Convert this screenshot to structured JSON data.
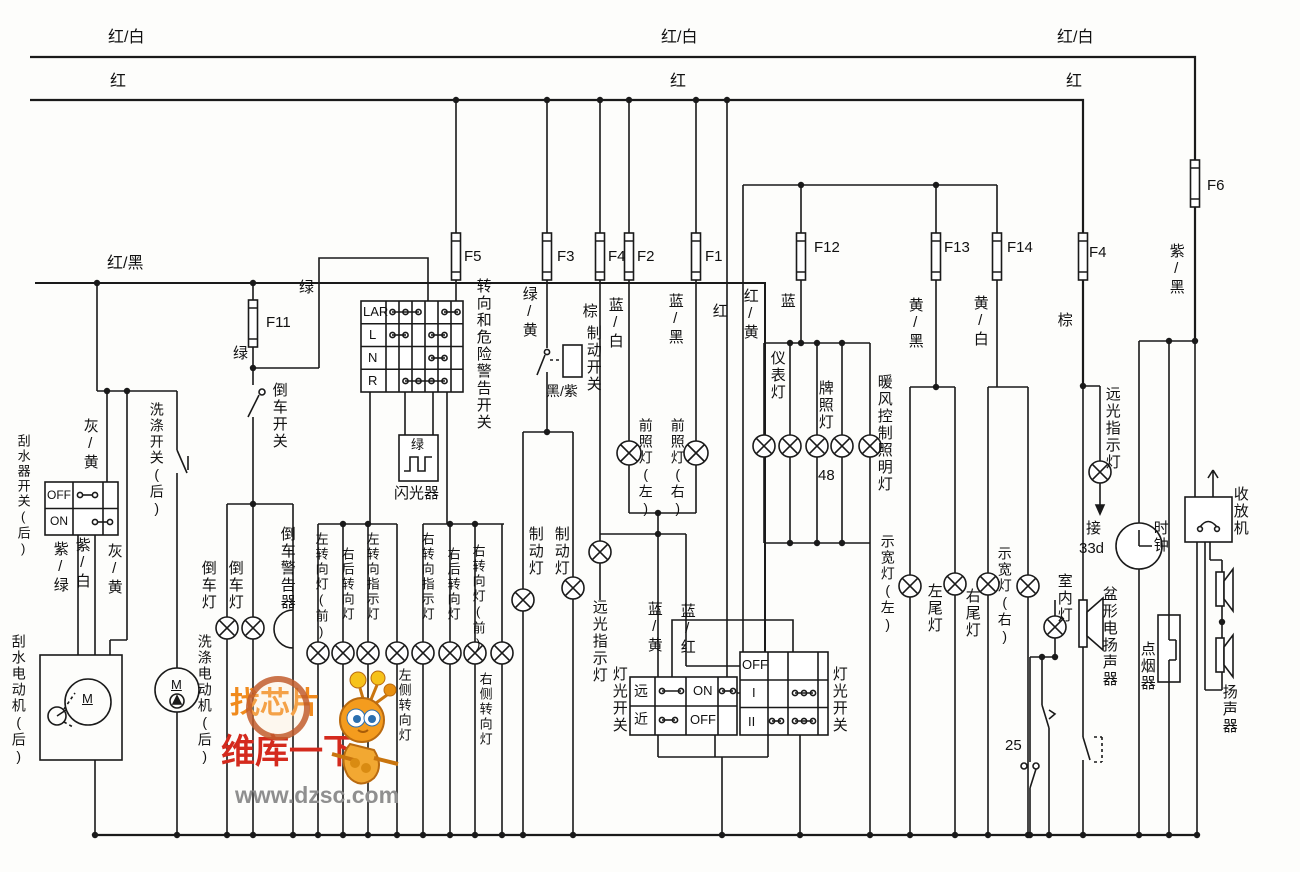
{
  "diagram_title": "汽车灯光与雨刮电路图",
  "watermark": {
    "line1": "找芯片",
    "line2": "维库一下",
    "line3": "www.dzsc.com",
    "color_orange": "#f08a1d",
    "color_red": "#d42a1d",
    "color_gray": "#8f8f8f"
  },
  "fuses": [
    "F1",
    "F2",
    "F3",
    "F4",
    "F5",
    "F6",
    "F11",
    "F12",
    "F13",
    "F14"
  ],
  "labels": [
    {
      "n": "bus-red-white-label-1",
      "t": "红/白",
      "x": 108,
      "y": 30,
      "o": "h",
      "fs": 16
    },
    {
      "n": "bus-red-white-label-2",
      "t": "红/白",
      "x": 661,
      "y": 30,
      "o": "h",
      "fs": 16
    },
    {
      "n": "bus-red-white-label-3",
      "t": "红/白",
      "x": 1057,
      "y": 30,
      "o": "h",
      "fs": 16
    },
    {
      "n": "bus-red-label-1",
      "t": "红",
      "x": 110,
      "y": 74,
      "o": "h",
      "fs": 16
    },
    {
      "n": "bus-red-label-2",
      "t": "红",
      "x": 670,
      "y": 74,
      "o": "h",
      "fs": 16
    },
    {
      "n": "bus-red-label-3",
      "t": "红",
      "x": 1066,
      "y": 74,
      "o": "h",
      "fs": 16
    },
    {
      "n": "bus-red-black-label",
      "t": "红/黑",
      "x": 107,
      "y": 256,
      "o": "h",
      "fs": 16
    },
    {
      "n": "fuse-label-f11",
      "t": "F11",
      "x": 266,
      "y": 315,
      "o": "h"
    },
    {
      "n": "wire-label-green-1",
      "t": "绿",
      "x": 299,
      "y": 280,
      "o": "h"
    },
    {
      "n": "wire-label-green-2",
      "t": "绿",
      "x": 233,
      "y": 346,
      "o": "h"
    },
    {
      "n": "reverse-switch-label",
      "t": "倒车开关",
      "x": 271,
      "y": 382,
      "o": "v"
    },
    {
      "n": "fuse-label-f5",
      "t": "F5",
      "x": 464,
      "y": 249,
      "o": "h"
    },
    {
      "n": "turn-hazard-switch-label",
      "t": "转向和危险警告开关",
      "x": 475,
      "y": 278,
      "o": "v"
    },
    {
      "n": "flasher-green-label",
      "t": "绿",
      "x": 411,
      "y": 438,
      "o": "h",
      "fs": 13
    },
    {
      "n": "flasher-label",
      "t": "闪光器",
      "x": 394,
      "y": 486,
      "o": "h"
    },
    {
      "n": "wire-label-green-yellow",
      "t": "绿/黄",
      "x": 521,
      "y": 286,
      "o": "v"
    },
    {
      "n": "wire-label-brown-1",
      "t": "棕",
      "x": 581,
      "y": 303,
      "o": "v"
    },
    {
      "n": "brake-switch-label",
      "t": "制动开关",
      "x": 585,
      "y": 325,
      "o": "v"
    },
    {
      "n": "wire-label-black-purple",
      "t": "黑/紫",
      "x": 546,
      "y": 384,
      "o": "h",
      "fs": 14
    },
    {
      "n": "wire-label-blue-white",
      "t": "蓝/白",
      "x": 607,
      "y": 297,
      "o": "v"
    },
    {
      "n": "fuse-label-f3",
      "t": "F3",
      "x": 557,
      "y": 249,
      "o": "h"
    },
    {
      "n": "fuse-label-f4",
      "t": "F4",
      "x": 608,
      "y": 249,
      "o": "h"
    },
    {
      "n": "fuse-label-f2",
      "t": "F2",
      "x": 637,
      "y": 249,
      "o": "h"
    },
    {
      "n": "fuse-label-f1",
      "t": "F1",
      "x": 705,
      "y": 249,
      "o": "h"
    },
    {
      "n": "wire-label-blue-black",
      "t": "蓝/黑",
      "x": 667,
      "y": 293,
      "o": "v"
    },
    {
      "n": "wire-label-red-v",
      "t": "红",
      "x": 711,
      "y": 303,
      "o": "v"
    },
    {
      "n": "headlamp-left-label",
      "t": "前照灯(左)",
      "x": 638,
      "y": 418,
      "o": "v",
      "fs": 14
    },
    {
      "n": "headlamp-right-label",
      "t": "前照灯(右)",
      "x": 670,
      "y": 418,
      "o": "v",
      "fs": 14
    },
    {
      "n": "wire-label-red-yellow",
      "t": "红/黄",
      "x": 742,
      "y": 288,
      "o": "v"
    },
    {
      "n": "wire-label-blue",
      "t": "蓝",
      "x": 779,
      "y": 293,
      "o": "v"
    },
    {
      "n": "fuse-label-f12",
      "t": "F12",
      "x": 814,
      "y": 240,
      "o": "h"
    },
    {
      "n": "instrument-lamp-label",
      "t": "仪表灯",
      "x": 769,
      "y": 350,
      "o": "v"
    },
    {
      "n": "license-lamp-label",
      "t": "牌照灯",
      "x": 817,
      "y": 380,
      "o": "v"
    },
    {
      "n": "heater-illum-lamp-label",
      "t": "暖风控制照明灯",
      "x": 876,
      "y": 374,
      "o": "v"
    },
    {
      "n": "terminal-48-label",
      "t": "48",
      "x": 818,
      "y": 468,
      "o": "h"
    },
    {
      "n": "fuse-label-f13",
      "t": "F13",
      "x": 944,
      "y": 240,
      "o": "h"
    },
    {
      "n": "wire-label-yellow-black",
      "t": "黄/黑",
      "x": 907,
      "y": 297,
      "o": "v"
    },
    {
      "n": "fuse-label-f14",
      "t": "F14",
      "x": 1007,
      "y": 240,
      "o": "h"
    },
    {
      "n": "wire-label-yellow-white",
      "t": "黄/白",
      "x": 972,
      "y": 295,
      "o": "v"
    },
    {
      "n": "fuse-label-f4-right",
      "t": "F4",
      "x": 1089,
      "y": 245,
      "o": "h"
    },
    {
      "n": "wire-label-brown-2",
      "t": "棕",
      "x": 1056,
      "y": 312,
      "o": "v"
    },
    {
      "n": "fuse-label-f6",
      "t": "F6",
      "x": 1207,
      "y": 178,
      "o": "h"
    },
    {
      "n": "wire-label-purple-black",
      "t": "紫/黑",
      "x": 1168,
      "y": 243,
      "o": "v"
    },
    {
      "n": "brake-lamp-label-1",
      "t": "制动灯",
      "x": 527,
      "y": 526,
      "o": "v"
    },
    {
      "n": "brake-lamp-label-2",
      "t": "制动灯",
      "x": 553,
      "y": 526,
      "o": "v"
    },
    {
      "n": "highbeam-indicator-label-c",
      "t": "远光指示灯",
      "x": 591,
      "y": 599,
      "o": "v"
    },
    {
      "n": "wire-label-blue-yellow",
      "t": "蓝/黄",
      "x": 646,
      "y": 601,
      "o": "v"
    },
    {
      "n": "wire-label-blue-red",
      "t": "蓝/红",
      "x": 679,
      "y": 603,
      "o": "v"
    },
    {
      "n": "light-switch-label-left",
      "t": "灯光开关",
      "x": 611,
      "y": 666,
      "o": "v"
    },
    {
      "n": "light-switch-label-right",
      "t": "灯光开关",
      "x": 831,
      "y": 666,
      "o": "v"
    },
    {
      "n": "position-lamp-left-label",
      "t": "示宽灯(左)",
      "x": 880,
      "y": 534,
      "o": "v",
      "fs": 14
    },
    {
      "n": "tail-lamp-left-label",
      "t": "左尾灯",
      "x": 926,
      "y": 583,
      "o": "v"
    },
    {
      "n": "tail-lamp-right-label",
      "t": "右尾灯",
      "x": 964,
      "y": 588,
      "o": "v"
    },
    {
      "n": "position-lamp-right-label",
      "t": "示宽灯(右)",
      "x": 997,
      "y": 546,
      "o": "v",
      "fs": 14
    },
    {
      "n": "room-lamp-label",
      "t": "室内灯",
      "x": 1056,
      "y": 573,
      "o": "v"
    },
    {
      "n": "highbeam-indicator-label-r",
      "t": "远光指示灯",
      "x": 1104,
      "y": 386,
      "o": "v"
    },
    {
      "n": "terminal-33d-label-1",
      "t": "接",
      "x": 1086,
      "y": 521,
      "o": "h"
    },
    {
      "n": "terminal-33d-label-2",
      "t": "33d",
      "x": 1079,
      "y": 541,
      "o": "h"
    },
    {
      "n": "clock-label",
      "t": "时钟",
      "x": 1152,
      "y": 520,
      "o": "v"
    },
    {
      "n": "horn-speaker-label",
      "t": "盆形电扬声器",
      "x": 1101,
      "y": 586,
      "o": "v"
    },
    {
      "n": "cigarette-lighter-label",
      "t": "点烟器",
      "x": 1139,
      "y": 641,
      "o": "v"
    },
    {
      "n": "radio-label",
      "t": "收放机",
      "x": 1232,
      "y": 486,
      "o": "v"
    },
    {
      "n": "speaker-label",
      "t": "扬声器",
      "x": 1221,
      "y": 684,
      "o": "v"
    },
    {
      "n": "terminal-25-label",
      "t": "25",
      "x": 1005,
      "y": 738,
      "o": "h"
    },
    {
      "n": "wire-label-gray-yellow-1",
      "t": "灰/黄",
      "x": 82,
      "y": 418,
      "o": "v"
    },
    {
      "n": "wiper-switch-label",
      "t": "刮水器开关(后)",
      "x": 16,
      "y": 434,
      "o": "v",
      "fs": 13
    },
    {
      "n": "wire-label-purple-green",
      "t": "紫/绿",
      "x": 52,
      "y": 541,
      "o": "v"
    },
    {
      "n": "wire-label-purple-white",
      "t": "紫/白",
      "x": 74,
      "y": 537,
      "o": "v"
    },
    {
      "n": "wire-label-gray-yellow-2",
      "t": "灰/黄",
      "x": 106,
      "y": 543,
      "o": "v"
    },
    {
      "n": "wiper-motor-label",
      "t": "刮水电动机(后)",
      "x": 11,
      "y": 634,
      "o": "v",
      "fs": 14
    },
    {
      "n": "washer-switch-label",
      "t": "洗涤开关(后)",
      "x": 149,
      "y": 402,
      "o": "v",
      "fs": 14
    },
    {
      "n": "washer-motor-label",
      "t": "洗涤电动机(后)",
      "x": 197,
      "y": 634,
      "o": "v",
      "fs": 14
    },
    {
      "n": "reverse-lamp-label-1",
      "t": "倒车灯",
      "x": 200,
      "y": 560,
      "o": "v"
    },
    {
      "n": "reverse-lamp-label-2",
      "t": "倒车灯",
      "x": 227,
      "y": 560,
      "o": "v"
    },
    {
      "n": "reverse-buzzer-label",
      "t": "倒车警告器",
      "x": 279,
      "y": 526,
      "o": "v"
    },
    {
      "n": "turn-lamp-lf-label",
      "t": "左转向灯(前)",
      "x": 314,
      "y": 532,
      "o": "v",
      "fs": 13
    },
    {
      "n": "turn-lamp-rr-label-1",
      "t": "右后转向灯",
      "x": 340,
      "y": 547,
      "o": "v",
      "fs": 13
    },
    {
      "n": "turn-ind-left-label",
      "t": "左转向指示灯",
      "x": 365,
      "y": 532,
      "o": "v",
      "fs": 13
    },
    {
      "n": "turn-lamp-lside-label",
      "t": "左侧转向灯",
      "x": 397,
      "y": 668,
      "o": "v",
      "fs": 13
    },
    {
      "n": "turn-ind-right-label",
      "t": "右转向指示灯",
      "x": 420,
      "y": 532,
      "o": "v",
      "fs": 13
    },
    {
      "n": "turn-lamp-rr-label-2",
      "t": "右后转向灯",
      "x": 446,
      "y": 547,
      "o": "v",
      "fs": 13
    },
    {
      "n": "turn-lamp-rf-label",
      "t": "右转向灯(前)",
      "x": 471,
      "y": 544,
      "o": "v",
      "fs": 13
    },
    {
      "n": "turn-lamp-rside-label",
      "t": "右侧转向灯",
      "x": 478,
      "y": 672,
      "o": "v",
      "fs": 13
    },
    {
      "n": "turn-switch-row-lar",
      "t": "LAR",
      "x": 363,
      "y": 305,
      "o": "h",
      "fs": 13
    },
    {
      "n": "turn-switch-row-l",
      "t": "L",
      "x": 369,
      "y": 328,
      "o": "h",
      "fs": 13
    },
    {
      "n": "turn-switch-row-n",
      "t": "N",
      "x": 368,
      "y": 351,
      "o": "h",
      "fs": 13
    },
    {
      "n": "turn-switch-row-r",
      "t": "R",
      "x": 368,
      "y": 374,
      "o": "h",
      "fs": 13
    },
    {
      "n": "wiper-switch-off",
      "t": "OFF",
      "x": 47,
      "y": 489,
      "o": "h",
      "fs": 12
    },
    {
      "n": "wiper-switch-on",
      "t": "ON",
      "x": 50,
      "y": 515,
      "o": "h",
      "fs": 12
    },
    {
      "n": "dimmer-row-far",
      "t": "远",
      "x": 634,
      "y": 684,
      "o": "h",
      "fs": 14
    },
    {
      "n": "dimmer-row-near",
      "t": "近",
      "x": 634,
      "y": 712,
      "o": "h",
      "fs": 14
    },
    {
      "n": "dimmer-on",
      "t": "ON",
      "x": 693,
      "y": 684,
      "o": "h",
      "fs": 13
    },
    {
      "n": "dimmer-off",
      "t": "OFF",
      "x": 690,
      "y": 713,
      "o": "h",
      "fs": 13
    },
    {
      "n": "main-switch-off",
      "t": "OFF",
      "x": 742,
      "y": 658,
      "o": "h",
      "fs": 13
    },
    {
      "n": "main-switch-i",
      "t": "I",
      "x": 752,
      "y": 686,
      "o": "h",
      "fs": 13
    },
    {
      "n": "main-switch-ii",
      "t": "II",
      "x": 748,
      "y": 715,
      "o": "h",
      "fs": 13
    },
    {
      "n": "wiper-motor-m",
      "t": "M",
      "x": 82,
      "y": 692,
      "o": "h",
      "fs": 13,
      "u": 1
    },
    {
      "n": "washer-motor-m",
      "t": "M",
      "x": 171,
      "y": 678,
      "o": "h",
      "fs": 13,
      "u": 1
    },
    {
      "n": "watermark-text-1",
      "t": "找芯片",
      "x": 230,
      "y": 688,
      "o": "h",
      "fs": 30,
      "c": "#f08a1d",
      "b": 1,
      "wm": 1
    },
    {
      "n": "watermark-text-2",
      "t": "维库一下",
      "x": 221,
      "y": 735,
      "o": "h",
      "fs": 34,
      "c": "#d42a1d",
      "b": 1,
      "wm": 1
    },
    {
      "n": "watermark-text-3",
      "t": "www.dzsc.com",
      "x": 235,
      "y": 783,
      "o": "h",
      "fs": 23,
      "c": "#8f8f8f",
      "b": 1,
      "wm": 1
    }
  ]
}
